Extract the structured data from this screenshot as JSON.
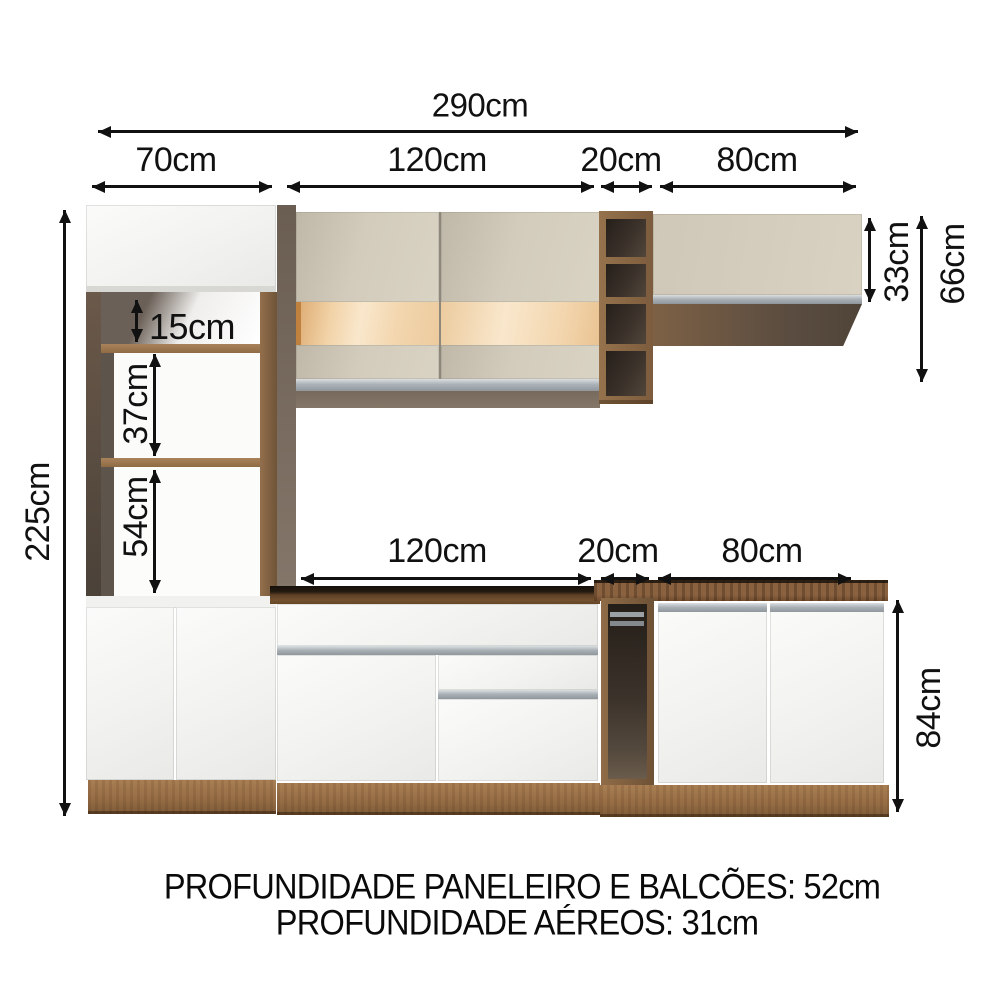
{
  "dims": {
    "total_width": "290cm",
    "tall_width": "70cm",
    "upper_mid_width": "120cm",
    "upper_niche_width": "20cm",
    "upper_right_width": "80cm",
    "total_height": "225cm",
    "tall_niche_1": "15cm",
    "tall_niche_2": "37cm",
    "tall_niche_3": "54cm",
    "upper_right_height": "33cm",
    "upper_total_height": "66cm",
    "base_mid_width": "120cm",
    "base_niche_width": "20cm",
    "base_right_width": "80cm",
    "base_height": "84cm"
  },
  "footer": {
    "depth_tall_and_base": "PROFUNDIDADE PANELEIRO E BALCÕES: 52cm",
    "depth_wall": "PROFUNDIDADE AÉREOS: 31cm"
  },
  "colors": {
    "wood_frame": "#8a6a4a",
    "wood_plinth": "#9a7148",
    "countertop_dark": "#5e422a",
    "door_white": "#f4f4f3",
    "door_cream": "#d2cbbb",
    "glass_amber": "#f3d6ae",
    "interior_dark": "#42382f",
    "handle_gray": "#a6adb2",
    "dimension_text": "#111111"
  }
}
